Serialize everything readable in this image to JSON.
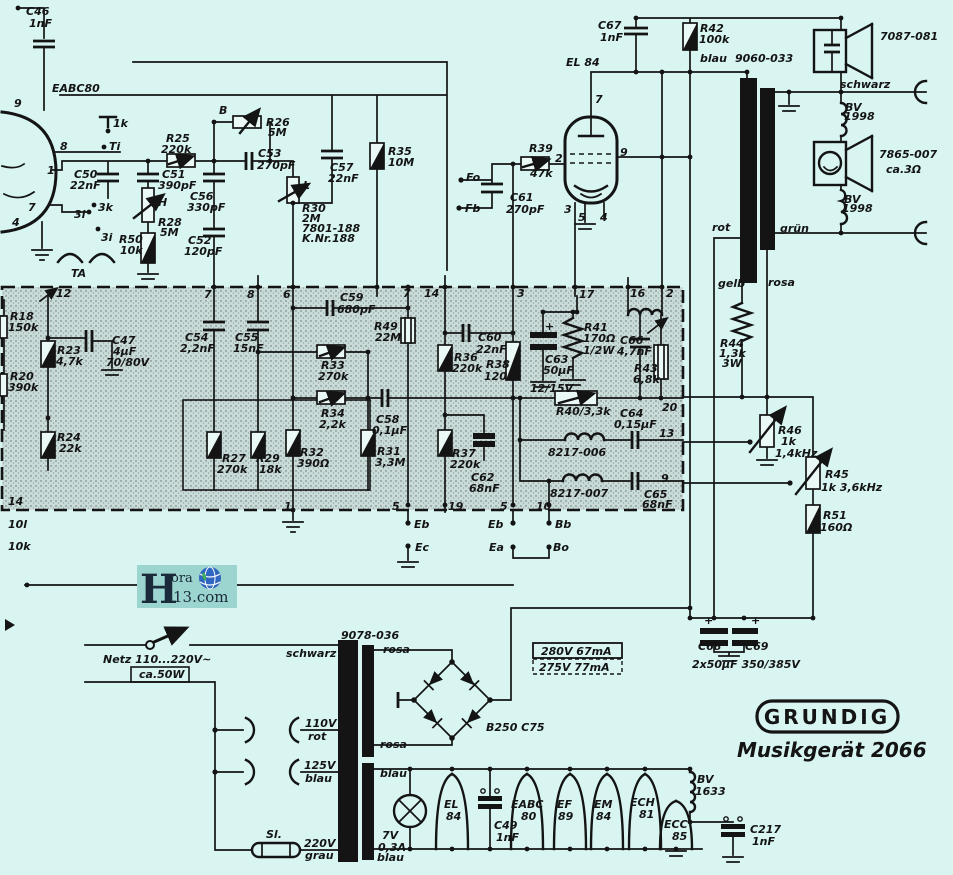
{
  "logo": {
    "brand": "GRUNDIG",
    "model": "Musikgerät 2066"
  },
  "watermark": {
    "gothic_h": "H",
    "line1": "ora",
    "line2": "13.com"
  },
  "colors": {
    "page_bg": "#d8f5f2",
    "ink": "#141414",
    "band_base": "#c9dbd9",
    "band_dot": "#5f6f6d",
    "watermark_bg": "#9cd4cf",
    "globe_blue": "#2e66c0"
  },
  "labels": [
    {
      "t": "C46",
      "x": 26,
      "y": 15
    },
    {
      "t": "1nF",
      "x": 29,
      "y": 27
    },
    {
      "t": "EABC80",
      "x": 52,
      "y": 92,
      "fs": 15
    },
    {
      "t": "1k",
      "x": 113,
      "y": 127
    },
    {
      "t": "Ti",
      "x": 109,
      "y": 150
    },
    {
      "t": "R25",
      "x": 166,
      "y": 142
    },
    {
      "t": "220k",
      "x": 161,
      "y": 153
    },
    {
      "t": "C50",
      "x": 74,
      "y": 178
    },
    {
      "t": "22nF",
      "x": 70,
      "y": 189
    },
    {
      "t": "C51",
      "x": 162,
      "y": 178
    },
    {
      "t": "390pF",
      "x": 158,
      "y": 189
    },
    {
      "t": "H",
      "x": 158,
      "y": 206,
      "fs": 14
    },
    {
      "t": "C56",
      "x": 190,
      "y": 200
    },
    {
      "t": "330pF",
      "x": 187,
      "y": 211
    },
    {
      "t": "R28",
      "x": 158,
      "y": 226
    },
    {
      "t": "5M",
      "x": 160,
      "y": 236
    },
    {
      "t": "R50",
      "x": 119,
      "y": 243
    },
    {
      "t": "10k",
      "x": 120,
      "y": 254
    },
    {
      "t": "C52",
      "x": 188,
      "y": 244
    },
    {
      "t": "120pF",
      "x": 184,
      "y": 255
    },
    {
      "t": "3k",
      "x": 98,
      "y": 211
    },
    {
      "t": "3l",
      "x": 74,
      "y": 218
    },
    {
      "t": "3i",
      "x": 101,
      "y": 241
    },
    {
      "t": "TA",
      "x": 71,
      "y": 277,
      "fs": 14
    },
    {
      "t": "B",
      "x": 219,
      "y": 114,
      "fs": 16
    },
    {
      "t": "R26",
      "x": 266,
      "y": 126
    },
    {
      "t": "5M",
      "x": 268,
      "y": 136
    },
    {
      "t": "C53",
      "x": 258,
      "y": 157
    },
    {
      "t": "270pF",
      "x": 257,
      "y": 169
    },
    {
      "t": "L",
      "x": 303,
      "y": 189,
      "fs": 16
    },
    {
      "t": "R30",
      "x": 302,
      "y": 212,
      "fs": 10
    },
    {
      "t": "2M",
      "x": 302,
      "y": 222,
      "fs": 10
    },
    {
      "t": "7801-188",
      "x": 302,
      "y": 232,
      "fs": 10
    },
    {
      "t": "K.Nr.188",
      "x": 302,
      "y": 242,
      "fs": 10
    },
    {
      "t": "C57",
      "x": 330,
      "y": 171
    },
    {
      "t": "22nF",
      "x": 328,
      "y": 182
    },
    {
      "t": "R35",
      "x": 388,
      "y": 155
    },
    {
      "t": "10M",
      "x": 388,
      "y": 166
    },
    {
      "t": "9",
      "x": 14,
      "y": 107,
      "fs": 9.5
    },
    {
      "t": "8",
      "x": 60,
      "y": 150,
      "fs": 9.5
    },
    {
      "t": "1",
      "x": 47,
      "y": 174,
      "fs": 9.5
    },
    {
      "t": "7",
      "x": 28,
      "y": 211,
      "fs": 9.5
    },
    {
      "t": "4",
      "x": 12,
      "y": 226,
      "fs": 9.5
    },
    {
      "t": "Fo",
      "x": 466,
      "y": 181
    },
    {
      "t": "Fb",
      "x": 465,
      "y": 212
    },
    {
      "t": "C61",
      "x": 510,
      "y": 201
    },
    {
      "t": "270pF",
      "x": 506,
      "y": 213
    },
    {
      "t": "R39",
      "x": 529,
      "y": 152
    },
    {
      "t": "47k",
      "x": 530,
      "y": 177
    },
    {
      "t": "EL 84",
      "x": 566,
      "y": 66,
      "fs": 14
    },
    {
      "t": "7",
      "x": 595,
      "y": 103,
      "fs": 9.5
    },
    {
      "t": "2",
      "x": 555,
      "y": 162,
      "fs": 9.5
    },
    {
      "t": "9",
      "x": 620,
      "y": 156,
      "fs": 9.5
    },
    {
      "t": "3",
      "x": 564,
      "y": 213,
      "fs": 9.5
    },
    {
      "t": "5",
      "x": 578,
      "y": 221,
      "fs": 9.5
    },
    {
      "t": "4",
      "x": 600,
      "y": 221,
      "fs": 9.5
    },
    {
      "t": "C67",
      "x": 598,
      "y": 29
    },
    {
      "t": "1nF",
      "x": 600,
      "y": 41
    },
    {
      "t": "R42",
      "x": 700,
      "y": 32
    },
    {
      "t": "100k",
      "x": 699,
      "y": 43
    },
    {
      "t": "blau",
      "x": 700,
      "y": 62
    },
    {
      "t": "9060-033",
      "x": 735,
      "y": 62
    },
    {
      "t": "7087-081",
      "x": 880,
      "y": 40
    },
    {
      "t": "schwarz",
      "x": 840,
      "y": 88
    },
    {
      "t": "BV",
      "x": 845,
      "y": 111,
      "fs": 9
    },
    {
      "t": "1998",
      "x": 844,
      "y": 120,
      "fs": 9
    },
    {
      "t": "7865-007",
      "x": 879,
      "y": 158
    },
    {
      "t": "ca.3Ω",
      "x": 886,
      "y": 173
    },
    {
      "t": "BV",
      "x": 844,
      "y": 203,
      "fs": 9
    },
    {
      "t": "1998",
      "x": 842,
      "y": 212,
      "fs": 9
    },
    {
      "t": "rot",
      "x": 712,
      "y": 231
    },
    {
      "t": "grün",
      "x": 780,
      "y": 232
    },
    {
      "t": "gelb",
      "x": 718,
      "y": 287
    },
    {
      "t": "rosa",
      "x": 768,
      "y": 286
    },
    {
      "t": "R44",
      "x": 720,
      "y": 347
    },
    {
      "t": "1,3k",
      "x": 719,
      "y": 357
    },
    {
      "t": "3W",
      "x": 722,
      "y": 367
    },
    {
      "t": "R18",
      "x": 10,
      "y": 320
    },
    {
      "t": "150k",
      "x": 8,
      "y": 331
    },
    {
      "t": "R23",
      "x": 57,
      "y": 354
    },
    {
      "t": "4,7k",
      "x": 56,
      "y": 365
    },
    {
      "t": "R20",
      "x": 10,
      "y": 380
    },
    {
      "t": "390k",
      "x": 8,
      "y": 391
    },
    {
      "t": "C47",
      "x": 112,
      "y": 344
    },
    {
      "t": "4µF",
      "x": 113,
      "y": 355
    },
    {
      "t": "70/80V",
      "x": 106,
      "y": 366
    },
    {
      "t": "R24",
      "x": 57,
      "y": 441
    },
    {
      "t": "22k",
      "x": 59,
      "y": 452
    },
    {
      "t": "12",
      "x": 56,
      "y": 297,
      "fs": 9.5
    },
    {
      "t": "14",
      "x": 8,
      "y": 505,
      "fs": 9.5
    },
    {
      "t": "10l",
      "x": 8,
      "y": 528
    },
    {
      "t": "10k",
      "x": 8,
      "y": 550
    },
    {
      "t": "7",
      "x": 204,
      "y": 298,
      "fs": 9.5
    },
    {
      "t": "8",
      "x": 247,
      "y": 298,
      "fs": 9.5
    },
    {
      "t": "6",
      "x": 283,
      "y": 298,
      "fs": 9.5
    },
    {
      "t": "7",
      "x": 403,
      "y": 297,
      "fs": 9.5
    },
    {
      "t": "14",
      "x": 424,
      "y": 297,
      "fs": 9.5
    },
    {
      "t": "3",
      "x": 517,
      "y": 297,
      "fs": 9.5
    },
    {
      "t": "17",
      "x": 579,
      "y": 298,
      "fs": 9.5
    },
    {
      "t": "16",
      "x": 630,
      "y": 297,
      "fs": 9.5
    },
    {
      "t": "2",
      "x": 666,
      "y": 297,
      "fs": 9.5
    },
    {
      "t": "C54",
      "x": 185,
      "y": 341
    },
    {
      "t": "2,2nF",
      "x": 180,
      "y": 352
    },
    {
      "t": "C55",
      "x": 235,
      "y": 341
    },
    {
      "t": "15nF",
      "x": 233,
      "y": 352
    },
    {
      "t": "C59",
      "x": 340,
      "y": 301
    },
    {
      "t": "680pF",
      "x": 337,
      "y": 313
    },
    {
      "t": "R49",
      "x": 374,
      "y": 330
    },
    {
      "t": "22M",
      "x": 375,
      "y": 341
    },
    {
      "t": "R33",
      "x": 321,
      "y": 369
    },
    {
      "t": "270k",
      "x": 318,
      "y": 380
    },
    {
      "t": "R34",
      "x": 321,
      "y": 417
    },
    {
      "t": "2,2k",
      "x": 319,
      "y": 428
    },
    {
      "t": "R27",
      "x": 222,
      "y": 462
    },
    {
      "t": "270k",
      "x": 217,
      "y": 473
    },
    {
      "t": "R29",
      "x": 256,
      "y": 462
    },
    {
      "t": "18k",
      "x": 259,
      "y": 473
    },
    {
      "t": "R32",
      "x": 300,
      "y": 456
    },
    {
      "t": "390Ω",
      "x": 297,
      "y": 467
    },
    {
      "t": "C58",
      "x": 376,
      "y": 423
    },
    {
      "t": "0,1µF",
      "x": 372,
      "y": 434
    },
    {
      "t": "R31",
      "x": 377,
      "y": 455
    },
    {
      "t": "3,3M",
      "x": 375,
      "y": 466
    },
    {
      "t": "C60",
      "x": 478,
      "y": 341
    },
    {
      "t": "22nF",
      "x": 476,
      "y": 353
    },
    {
      "t": "R36",
      "x": 454,
      "y": 361
    },
    {
      "t": "220k",
      "x": 452,
      "y": 372
    },
    {
      "t": "R38",
      "x": 486,
      "y": 368
    },
    {
      "t": "120k",
      "x": 484,
      "y": 380
    },
    {
      "t": "R37",
      "x": 452,
      "y": 457
    },
    {
      "t": "220k",
      "x": 450,
      "y": 468
    },
    {
      "t": "C62",
      "x": 471,
      "y": 481
    },
    {
      "t": "68nF",
      "x": 469,
      "y": 492
    },
    {
      "t": "+",
      "x": 545,
      "y": 330,
      "fs": 12
    },
    {
      "t": "C63",
      "x": 545,
      "y": 363
    },
    {
      "t": "50µF",
      "x": 543,
      "y": 374
    },
    {
      "t": "12/15V",
      "x": 530,
      "y": 392
    },
    {
      "t": "R41",
      "x": 584,
      "y": 331
    },
    {
      "t": "170Ω",
      "x": 583,
      "y": 342
    },
    {
      "t": "1/2W",
      "x": 583,
      "y": 354
    },
    {
      "t": "C66",
      "x": 620,
      "y": 344
    },
    {
      "t": "4,7nF",
      "x": 617,
      "y": 355
    },
    {
      "t": "R43",
      "x": 634,
      "y": 372
    },
    {
      "t": "6,8k",
      "x": 633,
      "y": 383
    },
    {
      "t": "R40/3,3k",
      "x": 556,
      "y": 415
    },
    {
      "t": "C64",
      "x": 620,
      "y": 417
    },
    {
      "t": "0,15µF",
      "x": 614,
      "y": 428
    },
    {
      "t": "8217-006",
      "x": 548,
      "y": 456
    },
    {
      "t": "8217-007",
      "x": 550,
      "y": 497
    },
    {
      "t": "C65",
      "x": 644,
      "y": 498
    },
    {
      "t": "68nF",
      "x": 642,
      "y": 508
    },
    {
      "t": "20",
      "x": 662,
      "y": 411,
      "fs": 9.5
    },
    {
      "t": "13",
      "x": 659,
      "y": 437,
      "fs": 9.5
    },
    {
      "t": "9",
      "x": 661,
      "y": 482,
      "fs": 9.5
    },
    {
      "t": "1",
      "x": 284,
      "y": 510,
      "fs": 9.5
    },
    {
      "t": "5",
      "x": 392,
      "y": 510,
      "fs": 9.5
    },
    {
      "t": "19",
      "x": 448,
      "y": 510,
      "fs": 9.5
    },
    {
      "t": "5",
      "x": 500,
      "y": 510,
      "fs": 9.5
    },
    {
      "t": "10",
      "x": 536,
      "y": 510,
      "fs": 9.5
    },
    {
      "t": "Eb",
      "x": 414,
      "y": 528
    },
    {
      "t": "Ec",
      "x": 415,
      "y": 551
    },
    {
      "t": "Eb",
      "x": 488,
      "y": 528
    },
    {
      "t": "Bb",
      "x": 555,
      "y": 528
    },
    {
      "t": "Ea",
      "x": 489,
      "y": 551
    },
    {
      "t": "Bo",
      "x": 553,
      "y": 551
    },
    {
      "t": "R46",
      "x": 778,
      "y": 434
    },
    {
      "t": "1k",
      "x": 781,
      "y": 445
    },
    {
      "t": "1,4kHz",
      "x": 775,
      "y": 457
    },
    {
      "t": "R45",
      "x": 825,
      "y": 478
    },
    {
      "t": "1k 3,6kHz",
      "x": 821,
      "y": 491
    },
    {
      "t": "R51",
      "x": 823,
      "y": 519
    },
    {
      "t": "160Ω",
      "x": 820,
      "y": 531
    },
    {
      "t": "Netz 110...220V~",
      "x": 103,
      "y": 663
    },
    {
      "t": "ca.50W",
      "x": 139,
      "y": 678
    },
    {
      "t": "schwarz",
      "x": 286,
      "y": 657
    },
    {
      "t": "9078-036",
      "x": 341,
      "y": 639
    },
    {
      "t": "rosa",
      "x": 383,
      "y": 653
    },
    {
      "t": "rosa",
      "x": 380,
      "y": 748
    },
    {
      "t": "110V",
      "x": 305,
      "y": 727
    },
    {
      "t": "rot",
      "x": 308,
      "y": 740
    },
    {
      "t": "125V",
      "x": 304,
      "y": 769
    },
    {
      "t": "blau",
      "x": 305,
      "y": 782
    },
    {
      "t": "Sl.",
      "x": 266,
      "y": 838
    },
    {
      "t": "220V",
      "x": 304,
      "y": 847
    },
    {
      "t": "grau",
      "x": 305,
      "y": 859
    },
    {
      "t": "blau",
      "x": 380,
      "y": 777
    },
    {
      "t": "blau",
      "x": 377,
      "y": 861
    },
    {
      "t": "7V",
      "x": 382,
      "y": 839
    },
    {
      "t": "0,3A",
      "x": 378,
      "y": 851
    },
    {
      "t": "B250 C75",
      "x": 486,
      "y": 731
    },
    {
      "t": "280V 67mA",
      "x": 541,
      "y": 655
    },
    {
      "t": "275V 77mA",
      "x": 539,
      "y": 671
    },
    {
      "t": "C68",
      "x": 698,
      "y": 650
    },
    {
      "t": "C69",
      "x": 745,
      "y": 650
    },
    {
      "t": "2x50µF 350/385V",
      "x": 692,
      "y": 668
    },
    {
      "t": "+",
      "x": 704,
      "y": 624,
      "fs": 12
    },
    {
      "t": "+",
      "x": 751,
      "y": 624,
      "fs": 12
    },
    {
      "t": "EL",
      "x": 444,
      "y": 808
    },
    {
      "t": "84",
      "x": 446,
      "y": 820
    },
    {
      "t": "C49",
      "x": 494,
      "y": 829
    },
    {
      "t": "1nF",
      "x": 496,
      "y": 841
    },
    {
      "t": "EABC",
      "x": 511,
      "y": 808
    },
    {
      "t": "80",
      "x": 521,
      "y": 820
    },
    {
      "t": "EF",
      "x": 557,
      "y": 808
    },
    {
      "t": "89",
      "x": 558,
      "y": 820
    },
    {
      "t": "EM",
      "x": 594,
      "y": 808
    },
    {
      "t": "84",
      "x": 596,
      "y": 820
    },
    {
      "t": "ECH",
      "x": 630,
      "y": 806
    },
    {
      "t": "81",
      "x": 639,
      "y": 818
    },
    {
      "t": "ECC",
      "x": 664,
      "y": 828
    },
    {
      "t": "85",
      "x": 672,
      "y": 840
    },
    {
      "t": "BV",
      "x": 697,
      "y": 783
    },
    {
      "t": "1633",
      "x": 695,
      "y": 795
    },
    {
      "t": "C217",
      "x": 750,
      "y": 833
    },
    {
      "t": "1nF",
      "x": 752,
      "y": 845
    }
  ]
}
